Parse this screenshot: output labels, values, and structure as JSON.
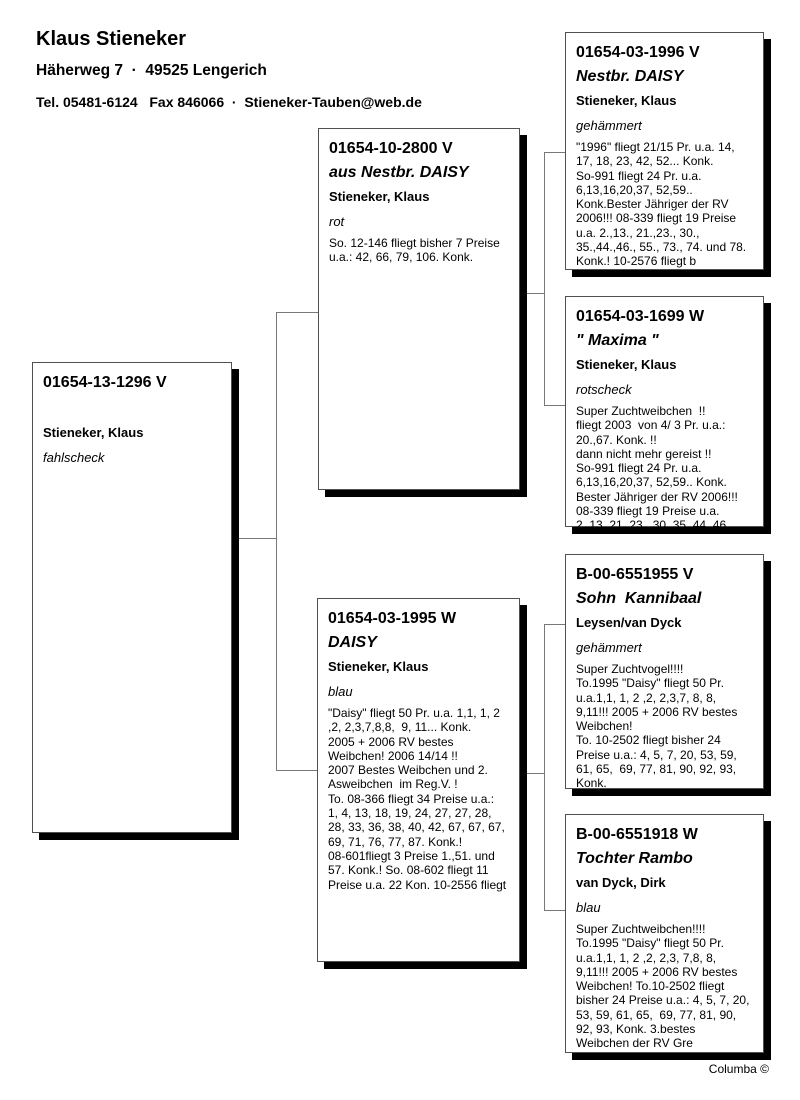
{
  "header": {
    "name": "Klaus Stieneker",
    "address": "Häherweg 7  ·  49525 Lengerich",
    "contact": "Tel. 05481-6124   Fax 846066  ·  Stieneker-Tauben@web.de"
  },
  "footer": {
    "credit": "Columba ©"
  },
  "boxes": {
    "subject": {
      "ring": "01654-13-1296 V",
      "owner": "Stieneker, Klaus",
      "color": "fahlscheck",
      "info": ""
    },
    "sire": {
      "ring": "01654-10-2800 V",
      "name": "aus Nestbr. DAISY",
      "owner": "Stieneker, Klaus",
      "color": "rot",
      "info": "So. 12-146 fliegt bisher 7 Preise\nu.a.: 42, 66, 79, 106. Konk."
    },
    "dam": {
      "ring": "01654-03-1995 W",
      "name": "DAISY",
      "owner": "Stieneker, Klaus",
      "color": "blau",
      "info": "\"Daisy\" fliegt 50 Pr. u.a. 1,1, 1, 2\n,2, 2,3,7,8,8,  9, 11... Konk.\n2005 + 2006 RV bestes\nWeibchen! 2006 14/14 !!\n2007 Bestes Weibchen und 2.\nAsweibchen  im Reg.V. !\nTo. 08-366 fliegt 34 Preise u.a.:\n1, 4, 13, 18, 19, 24, 27, 27, 28,\n28, 33, 36, 38, 40, 42, 67, 67, 67,\n69, 71, 76, 77, 87. Konk.!\n08-601fliegt 3 Preise 1.,51. und\n57. Konk.! So. 08-602 fliegt 11\nPreise u.a. 22 Kon. 10-2556 fliegt"
    },
    "sire_sire": {
      "ring": "01654-03-1996 V",
      "name": "Nestbr. DAISY",
      "owner": "Stieneker, Klaus",
      "color": "gehämmert",
      "info": "\"1996\" fliegt 21/15 Pr. u.a. 14,\n17, 18, 23, 42, 52... Konk.\nSo-991 fliegt 24 Pr. u.a.\n6,13,16,20,37, 52,59..\nKonk.Bester Jähriger der RV\n2006!!! 08-339 fliegt 19 Preise\nu.a. 2.,13., 21.,23., 30.,\n35.,44.,46., 55., 73., 74. und 78.\nKonk.! 10-2576 fliegt b"
    },
    "sire_dam": {
      "ring": "01654-03-1699 W",
      "name": "\" Maxima \"",
      "owner": "Stieneker, Klaus",
      "color": "rotscheck",
      "info": "Super Zuchtweibchen  !!\nfliegt 2003  von 4/ 3 Pr. u.a.:\n20.,67. Konk. !!\ndann nicht mehr gereist !!\nSo-991 fliegt 24 Pr. u.a.\n6,13,16,20,37, 52,59.. Konk.\nBester Jähriger der RV 2006!!!\n08-339 fliegt 19 Preise u.a.\n2.,13.,21.,23., 30.,35.,44.,46.,"
    },
    "dam_sire": {
      "ring": "B-00-6551955 V",
      "name": "Sohn  Kannibaal",
      "owner": "Leysen/van Dyck",
      "color": "gehämmert",
      "info": "Super Zuchtvogel!!!!\nTo.1995 \"Daisy\" fliegt 50 Pr.\nu.a.1,1, 1, 2 ,2, 2,3,7, 8, 8,\n9,11!!! 2005 + 2006 RV bestes\nWeibchen!\nTo. 10-2502 fliegt bisher 24\nPreise u.a.: 4, 5, 7, 20, 53, 59,\n61, 65,  69, 77, 81, 90, 92, 93,\nKonk."
    },
    "dam_dam": {
      "ring": "B-00-6551918 W",
      "name": "Tochter Rambo",
      "owner": "van Dyck, Dirk",
      "color": "blau",
      "info": "Super Zuchtweibchen!!!!\nTo.1995 \"Daisy\" fliegt 50 Pr.\nu.a.1,1, 1, 2 ,2, 2,3, 7,8, 8,\n9,11!!! 2005 + 2006 RV bestes\nWeibchen! To.10-2502 fliegt\nbisher 24 Preise u.a.: 4, 5, 7, 20,\n53, 59, 61, 65,  69, 77, 81, 90,\n92, 93, Konk. 3.bestes\nWeibchen der RV Gre"
    }
  }
}
